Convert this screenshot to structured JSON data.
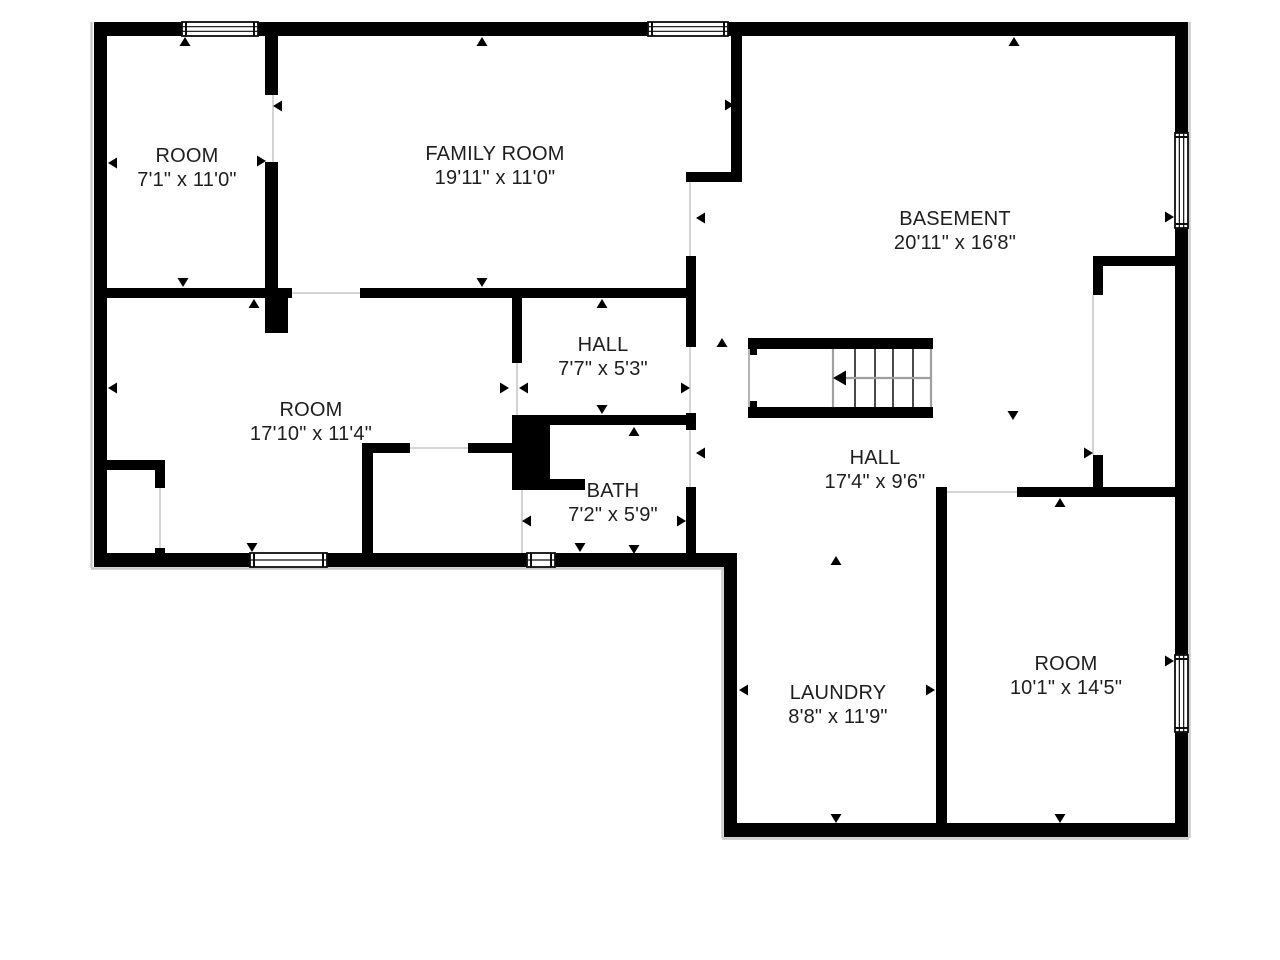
{
  "document": {
    "kind": "floor-plan",
    "background": "#ffffff",
    "wall_color": "#000000",
    "text_color": "#1e1e1e",
    "opening_line_color": "#d4d4d4",
    "shadow_color": "#c9c9c9",
    "label_font_size": 20
  },
  "rooms": [
    {
      "id": "room-top-left",
      "name": "ROOM",
      "dims": "7'1\" x 11'0\"",
      "cx": 187,
      "cy": 155
    },
    {
      "id": "family-room",
      "name": "FAMILY ROOM",
      "dims": "19'11\" x 11'0\"",
      "cx": 495,
      "cy": 153
    },
    {
      "id": "basement",
      "name": "BASEMENT",
      "dims": "20'11\" x 16'8\"",
      "cx": 955,
      "cy": 218
    },
    {
      "id": "hall-small",
      "name": "HALL",
      "dims": "7'7\" x 5'3\"",
      "cx": 603,
      "cy": 344
    },
    {
      "id": "room-middle",
      "name": "ROOM",
      "dims": "17'10\" x 11'4\"",
      "cx": 311,
      "cy": 409
    },
    {
      "id": "hall-large",
      "name": "HALL",
      "dims": "17'4\" x 9'6\"",
      "cx": 875,
      "cy": 457
    },
    {
      "id": "bath",
      "name": "BATH",
      "dims": "7'2\" x 5'9\"",
      "cx": 613,
      "cy": 490
    },
    {
      "id": "laundry",
      "name": "LAUNDRY",
      "dims": "8'8\" x 11'9\"",
      "cx": 838,
      "cy": 692
    },
    {
      "id": "room-bottom-right",
      "name": "ROOM",
      "dims": "10'1\" x 14'5\"",
      "cx": 1066,
      "cy": 663
    }
  ],
  "walls": [
    [
      94,
      22,
      1094,
      14
    ],
    [
      94,
      22,
      13,
      545
    ],
    [
      94,
      553,
      643,
      14
    ],
    [
      724,
      553,
      13,
      284
    ],
    [
      724,
      823,
      464,
      14
    ],
    [
      1175,
      22,
      13,
      815
    ],
    [
      265,
      22,
      13,
      73
    ],
    [
      265,
      162,
      13,
      136
    ],
    [
      94,
      288,
      198,
      10
    ],
    [
      265,
      288,
      23,
      45
    ],
    [
      360,
      288,
      330,
      10
    ],
    [
      512,
      298,
      10,
      65
    ],
    [
      731,
      22,
      11,
      160
    ],
    [
      686,
      172,
      56,
      10
    ],
    [
      686,
      256,
      10,
      91
    ],
    [
      686,
      413,
      10,
      17
    ],
    [
      686,
      487,
      10,
      66
    ],
    [
      512,
      415,
      180,
      10
    ],
    [
      512,
      415,
      38,
      75
    ],
    [
      550,
      479,
      35,
      11
    ],
    [
      362,
      443,
      48,
      10
    ],
    [
      468,
      443,
      50,
      10
    ],
    [
      362,
      443,
      11,
      110
    ],
    [
      94,
      460,
      71,
      10
    ],
    [
      155,
      460,
      10,
      28
    ],
    [
      155,
      548,
      10,
      8
    ],
    [
      1093,
      256,
      82,
      10
    ],
    [
      1093,
      256,
      10,
      39
    ],
    [
      1093,
      455,
      10,
      33
    ],
    [
      1017,
      487,
      158,
      10
    ],
    [
      936,
      487,
      11,
      336
    ]
  ],
  "windows": [
    {
      "x": 182,
      "y": 22,
      "w": 76,
      "h": 14,
      "o": "h",
      "lines": 2
    },
    {
      "x": 648,
      "y": 22,
      "w": 80,
      "h": 14,
      "o": "h",
      "lines": 2
    },
    {
      "x": 1175,
      "y": 133,
      "w": 13,
      "h": 95,
      "o": "v",
      "lines": 2
    },
    {
      "x": 1175,
      "y": 655,
      "w": 13,
      "h": 77,
      "o": "v",
      "lines": 2
    },
    {
      "x": 250,
      "y": 553,
      "w": 77,
      "h": 14,
      "o": "h",
      "lines": 1
    },
    {
      "x": 527,
      "y": 553,
      "w": 28,
      "h": 14,
      "o": "h",
      "lines": 1
    }
  ],
  "openings": [
    [
      273,
      95,
      273,
      162
    ],
    [
      690,
      182,
      690,
      256
    ],
    [
      517,
      363,
      517,
      415
    ],
    [
      690,
      347,
      690,
      413
    ],
    [
      690,
      430,
      690,
      487
    ],
    [
      410,
      448,
      468,
      448
    ],
    [
      160,
      488,
      160,
      548
    ],
    [
      292,
      293,
      360,
      293
    ],
    [
      947,
      492,
      1017,
      492
    ],
    [
      1093,
      295,
      1093,
      455
    ],
    [
      522,
      490,
      522,
      553
    ]
  ],
  "shadows": [
    [
      91.5,
      22,
      91.5,
      568
    ],
    [
      91,
      568.5,
      731,
      568.5
    ],
    [
      722.5,
      557,
      722.5,
      838
    ],
    [
      722,
      838.5,
      1189,
      838.5
    ],
    [
      1189.5,
      22,
      1189.5,
      838
    ]
  ],
  "markers": [
    {
      "x": 185,
      "y": 37,
      "dir": "up"
    },
    {
      "x": 482,
      "y": 37,
      "dir": "up"
    },
    {
      "x": 1014,
      "y": 37,
      "dir": "up"
    },
    {
      "x": 108,
      "y": 163,
      "dir": "left"
    },
    {
      "x": 108,
      "y": 388,
      "dir": "left"
    },
    {
      "x": 1174,
      "y": 217,
      "dir": "right"
    },
    {
      "x": 1174,
      "y": 661,
      "dir": "right"
    },
    {
      "x": 273,
      "y": 106,
      "dir": "left"
    },
    {
      "x": 266,
      "y": 161,
      "dir": "right"
    },
    {
      "x": 183,
      "y": 287,
      "dir": "down"
    },
    {
      "x": 254,
      "y": 299,
      "dir": "up"
    },
    {
      "x": 482,
      "y": 287,
      "dir": "down"
    },
    {
      "x": 602,
      "y": 299,
      "dir": "up"
    },
    {
      "x": 602,
      "y": 414,
      "dir": "down"
    },
    {
      "x": 634,
      "y": 427,
      "dir": "up"
    },
    {
      "x": 509,
      "y": 388,
      "dir": "right"
    },
    {
      "x": 519,
      "y": 388,
      "dir": "left"
    },
    {
      "x": 690,
      "y": 388,
      "dir": "right"
    },
    {
      "x": 696,
      "y": 218,
      "dir": "left"
    },
    {
      "x": 734,
      "y": 105,
      "dir": "right"
    },
    {
      "x": 696,
      "y": 453,
      "dir": "left"
    },
    {
      "x": 522,
      "y": 521,
      "dir": "left"
    },
    {
      "x": 686,
      "y": 521,
      "dir": "right"
    },
    {
      "x": 580,
      "y": 552,
      "dir": "down"
    },
    {
      "x": 634,
      "y": 554,
      "dir": "down"
    },
    {
      "x": 252,
      "y": 552,
      "dir": "down"
    },
    {
      "x": 836,
      "y": 556,
      "dir": "up"
    },
    {
      "x": 739,
      "y": 690,
      "dir": "left"
    },
    {
      "x": 935,
      "y": 690,
      "dir": "right"
    },
    {
      "x": 836,
      "y": 823,
      "dir": "down"
    },
    {
      "x": 1060,
      "y": 823,
      "dir": "down"
    },
    {
      "x": 1060,
      "y": 498,
      "dir": "up"
    },
    {
      "x": 1013,
      "y": 420,
      "dir": "down"
    },
    {
      "x": 1093,
      "y": 453,
      "dir": "right"
    },
    {
      "x": 722,
      "y": 338,
      "dir": "up"
    }
  ],
  "stairs": {
    "x": 748,
    "y": 338,
    "w": 185,
    "h": 80,
    "bar": 11,
    "tab_w": 9,
    "tab_h": 17,
    "treads": [
      855,
      875,
      893,
      913
    ],
    "gray_lines": [
      833,
      931
    ],
    "mid_y": 378,
    "mid_x1": 840,
    "mid_x2": 931,
    "arrow_x": 833,
    "arrow_y": 378
  }
}
